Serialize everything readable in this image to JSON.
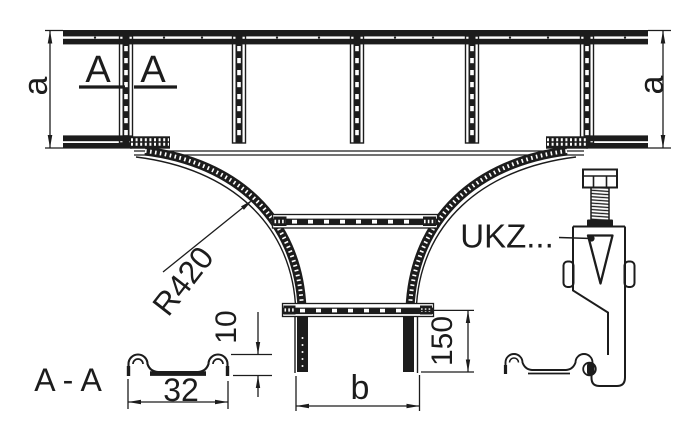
{
  "drawing": {
    "background": "#ffffff",
    "line_color": "#1c1c1c",
    "labels": {
      "section_cut_left": "A",
      "section_cut_right": "A",
      "section_view_title": "A - A",
      "clamp_ref": "UKZ..."
    },
    "dimensions": {
      "rail_width_left": "a",
      "rail_width_right": "a",
      "bend_radius": "R420",
      "branch_width": "b",
      "branch_stub_length": "150",
      "profile_height": "10",
      "profile_width": "32"
    }
  }
}
